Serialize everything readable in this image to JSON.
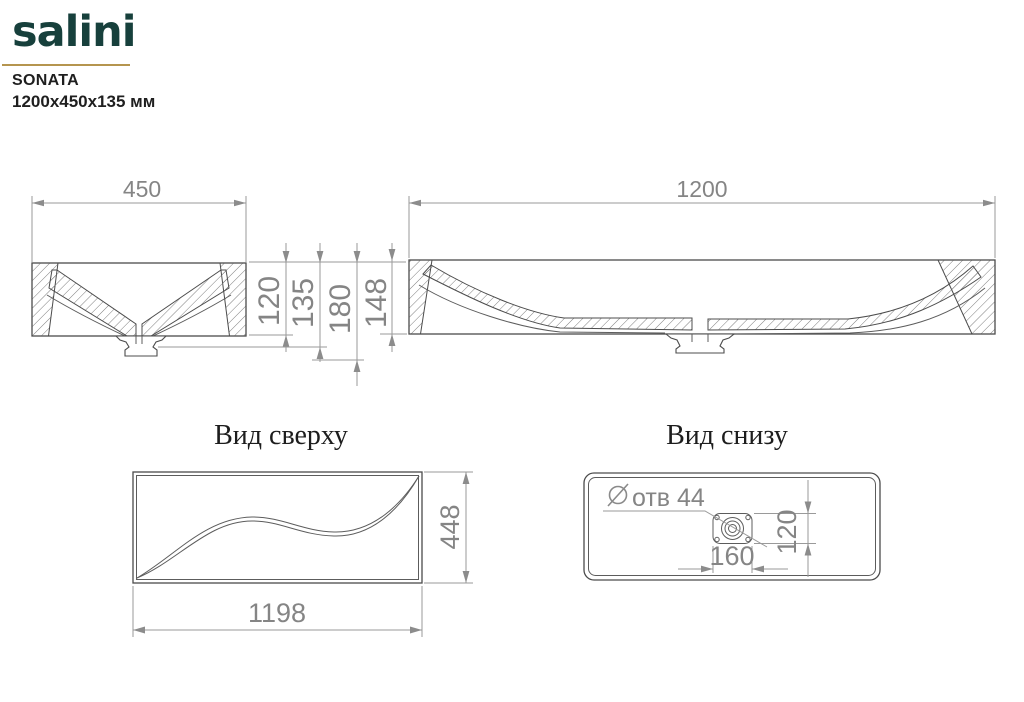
{
  "header": {
    "logo": "salini",
    "model": "SONATA",
    "size": "1200x450x135 мм"
  },
  "side_section": {
    "width": "450",
    "vertical": [
      "120",
      "135",
      "180",
      "148"
    ]
  },
  "front_section": {
    "width": "1200"
  },
  "top_view": {
    "title": "Вид сверху",
    "length": "1198",
    "width": "448"
  },
  "bottom_view": {
    "title": "Вид снизу",
    "hole_note": "отв 44",
    "drain_plate_width": "160",
    "drain_plate_height": "120"
  },
  "colors": {
    "logo": "#17403c",
    "gold": "#b5954f",
    "text": "#1f1f1f",
    "line": "#4c4c4c",
    "line2": "#5c5c5c",
    "dim": "#9a9a9a",
    "dim2": "#8c8c8c",
    "dimtext": "#858585"
  }
}
